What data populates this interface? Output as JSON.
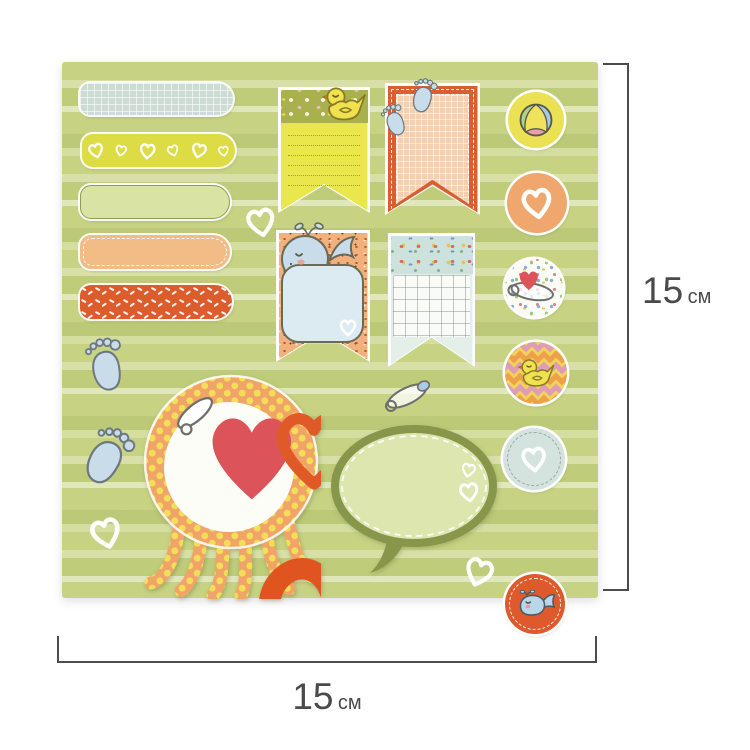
{
  "annotations": {
    "right_dimension": {
      "value": "15",
      "unit": "см"
    },
    "bottom_dimension": {
      "value": "15",
      "unit": "см"
    },
    "line_color": "#4d4d4d",
    "text_color": "#4a4a4a"
  },
  "sheet": {
    "description": "baby-themed scrapbook sticker sheet, 15 x 15 cm",
    "background": {
      "base": "#c7d383",
      "stripes": [
        "#dde6a8",
        "#bfce73",
        "#e9eecb"
      ]
    },
    "stickers": {
      "strips": [
        {
          "name": "grid-strip",
          "color": "#ccdcd2",
          "pattern": "white grid"
        },
        {
          "name": "hearts-strip",
          "color": "#dedc44",
          "pattern": "white hearts"
        },
        {
          "name": "plain-strip",
          "color": "#d9e4a4",
          "pattern": "plain"
        },
        {
          "name": "stitched-strip",
          "color": "#f2bc87",
          "pattern": "white stitch border"
        },
        {
          "name": "sprinkles-strip",
          "color": "#dc5c2c",
          "pattern": "white sprinkles"
        }
      ],
      "banners": [
        {
          "name": "duck-note-banner",
          "colors": [
            "#a9b14e",
            "#eae74d"
          ],
          "icon": "duck"
        },
        {
          "name": "footprints-banner",
          "colors": [
            "#d95f33",
            "#f5cfae"
          ],
          "icon": "baby footprints"
        },
        {
          "name": "whale-note-banner",
          "colors": [
            "#f0b17c",
            "#dcebf2"
          ],
          "icon": "whale"
        },
        {
          "name": "grid-note-banner",
          "colors": [
            "#cde2dc",
            "#e3efe8"
          ],
          "icon": "grid paper"
        }
      ],
      "round_stickers": [
        {
          "name": "beach-ball",
          "bg": "#eae254"
        },
        {
          "name": "white-heart",
          "bg": "#efa76d"
        },
        {
          "name": "safety-pin",
          "bg": "#fbfbf6"
        },
        {
          "name": "duck-chevron",
          "bg": "#f2d45a"
        },
        {
          "name": "heart-dashed",
          "bg": "#d4e3de"
        },
        {
          "name": "whale",
          "bg": "#de592b"
        }
      ],
      "octopus_frame": {
        "body": "#f1a468",
        "dots": "#f3de58",
        "center": "#fdfdf8"
      },
      "speech_bubble": {
        "fill": "#dde6ae",
        "border": "#87964a"
      },
      "footprints_color": "#c8dcea",
      "hearts_color": "#ffffff"
    }
  }
}
